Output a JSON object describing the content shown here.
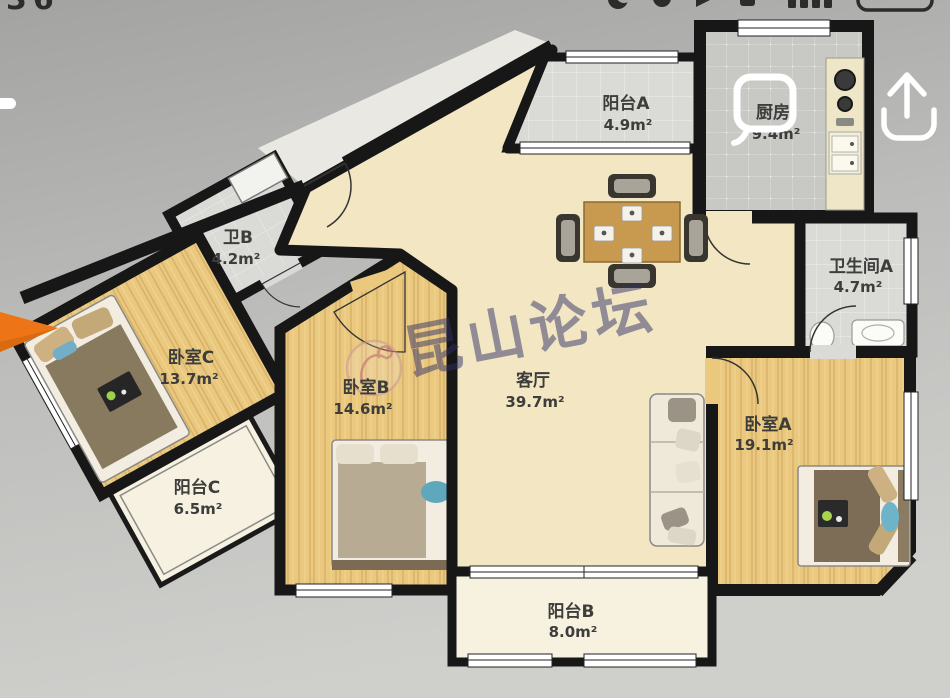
{
  "status_bar": {
    "time_fragment": "36",
    "icons": [
      "mute-icon",
      "clock-icon",
      "vpn-icon",
      "signal-bars-icon",
      "battery-icon"
    ]
  },
  "header": {
    "share_icon": "upload-share-icon"
  },
  "floor_plan": {
    "watermark": {
      "text": "昆山论坛",
      "logo": "phoenix-circle-logo"
    },
    "rooms": [
      {
        "id": "balcony-a",
        "name": "阳台A",
        "area": "4.9m²"
      },
      {
        "id": "kitchen",
        "name": "厨房",
        "area": "9.4m²"
      },
      {
        "id": "bath-b",
        "name": "卫B",
        "area": "4.2m²"
      },
      {
        "id": "bath-a",
        "name": "卫生间A",
        "area": "4.7m²"
      },
      {
        "id": "bedroom-c",
        "name": "卧室C",
        "area": "13.7m²"
      },
      {
        "id": "bedroom-b",
        "name": "卧室B",
        "area": "14.6m²"
      },
      {
        "id": "living-room",
        "name": "客厅",
        "area": "39.7m²"
      },
      {
        "id": "bedroom-a",
        "name": "卧室A",
        "area": "19.1m²"
      },
      {
        "id": "balcony-c",
        "name": "阳台C",
        "area": "6.5m²"
      },
      {
        "id": "balcony-b",
        "name": "阳台B",
        "area": "8.0m²"
      }
    ],
    "colors": {
      "wood_floor": "#eac97f",
      "tile_floor": "#c8c8c5",
      "living_floor": "#f2e6c3",
      "wall": "#171717",
      "highlight_outline": "#ffffff",
      "annotation_arrow": "#ee7517",
      "watermark_text": "rgba(48,48,105,0.5)"
    }
  }
}
